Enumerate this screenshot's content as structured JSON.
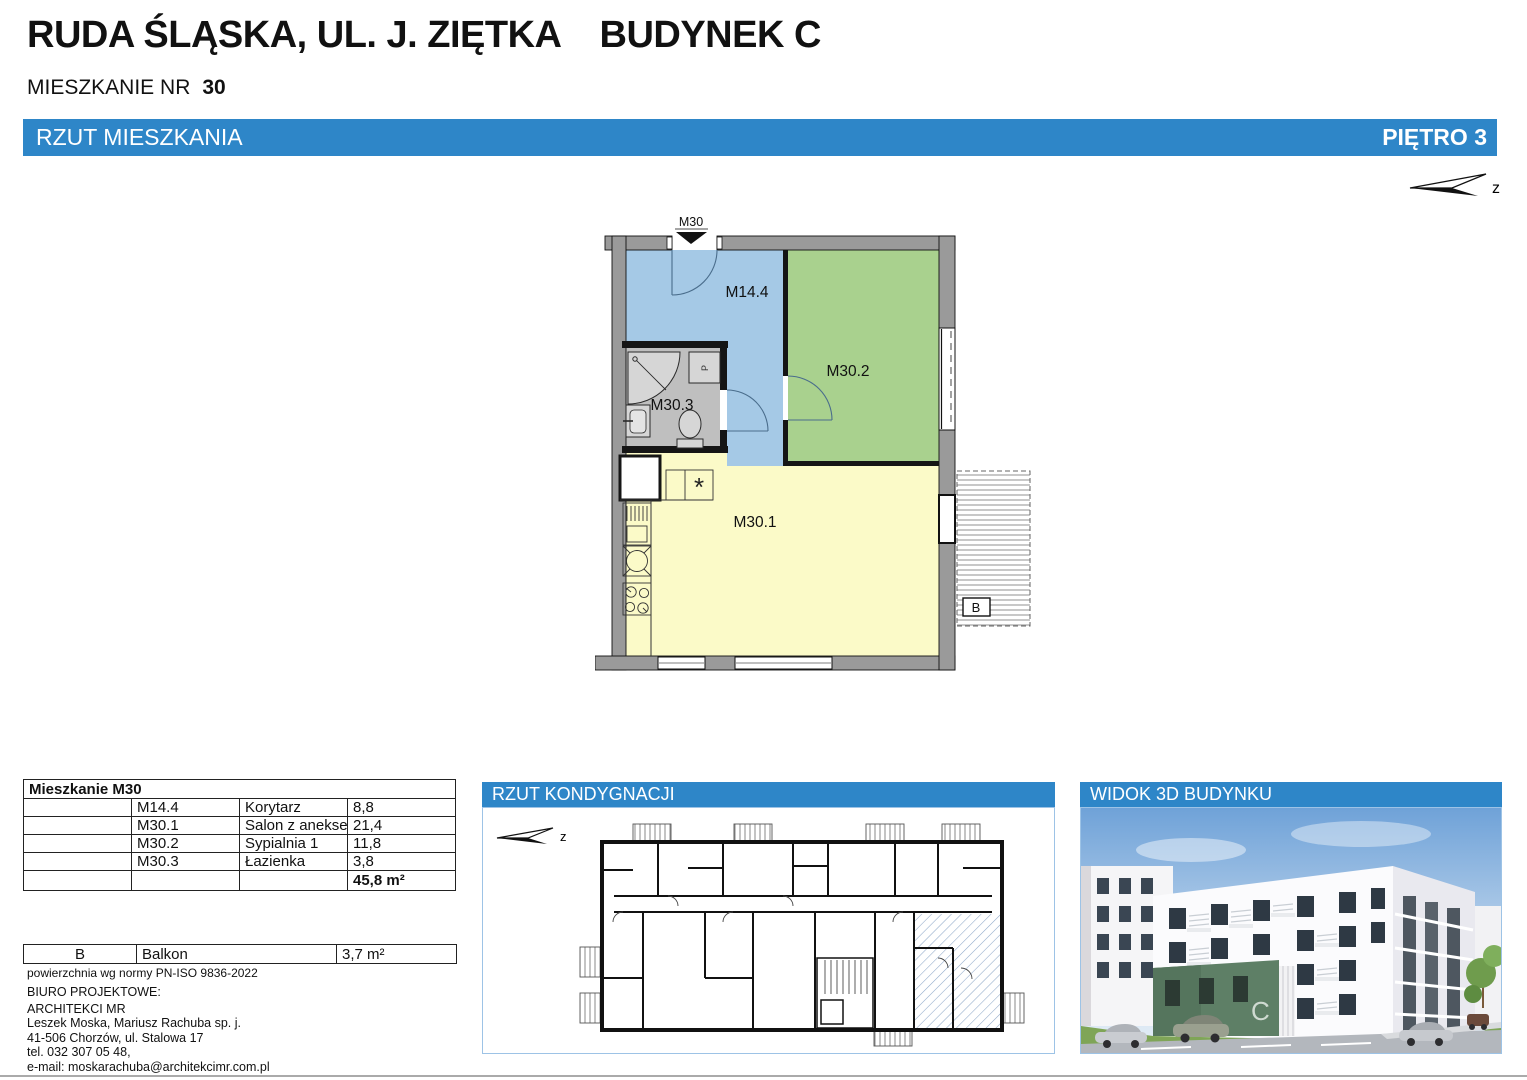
{
  "header": {
    "title_location": "RUDA ŚLĄSKA, UL. J. ZIĘTKA",
    "title_building": "BUDYNEK C",
    "apartment_label": "MIESZKANIE NR",
    "apartment_number": "30",
    "north_label": "z"
  },
  "banner": {
    "left": "RZUT MIESZKANIA",
    "right": "PIĘTRO 3"
  },
  "plan": {
    "entrance_label": "M30",
    "rooms": [
      {
        "label": "M14.4",
        "name": "Korytarz",
        "color": "#A5C9E6"
      },
      {
        "label": "M30.2",
        "name": "Sypialnia 1",
        "color": "#A9D18E"
      },
      {
        "label": "M30.3",
        "name": "Łazienka",
        "color": "#BFBFBF"
      },
      {
        "label": "M30.1",
        "name": "Salon z aneksem kuchennym",
        "color": "#FBFAC8"
      }
    ],
    "balcony_label": "B",
    "dishwasher_symbol": "*",
    "washer_symbol": "P"
  },
  "area_table": {
    "title": "Mieszkanie M30",
    "rows": [
      {
        "code": "M14.4",
        "name": "Korytarz",
        "area": "8,8"
      },
      {
        "code": "M30.1",
        "name": "Salon z aneksem kuchennym",
        "area": "21,4"
      },
      {
        "code": "M30.2",
        "name": "Sypialnia 1",
        "area": "11,8"
      },
      {
        "code": "M30.3",
        "name": "Łazienka",
        "area": "3,8"
      }
    ],
    "total": "45,8 m²"
  },
  "balcony_table": {
    "code": "B",
    "name": "Balkon",
    "area": "3,7 m²"
  },
  "footnote": "powierzchnia wg normy PN-ISO 9836-2022",
  "office": {
    "label": "BIURO PROJEKTOWE:",
    "name": "ARCHITEKCI MR",
    "partners": "Leszek Moska, Mariusz Rachuba sp. j.",
    "address": "41-506 Chorzów, ul. Stalowa 17",
    "phone": "tel. 032 307 05 48,",
    "email": "e-mail: moskarachuba@architekcimr.com.pl"
  },
  "panels": {
    "floor_overview": {
      "title": "RZUT KONDYGNACJI",
      "north_label": "z"
    },
    "view3d": {
      "title": "WIDOK 3D BUDYNKU",
      "building_letter": "C"
    }
  },
  "colors": {
    "accent_blue": "#2E86C8",
    "panel_border": "#9DC3E6",
    "corridor": "#A5C9E6",
    "bedroom": "#A9D18E",
    "bathroom": "#BFBFBF",
    "living_room": "#FBFAC8",
    "wall_gray": "#9A9A9A"
  }
}
